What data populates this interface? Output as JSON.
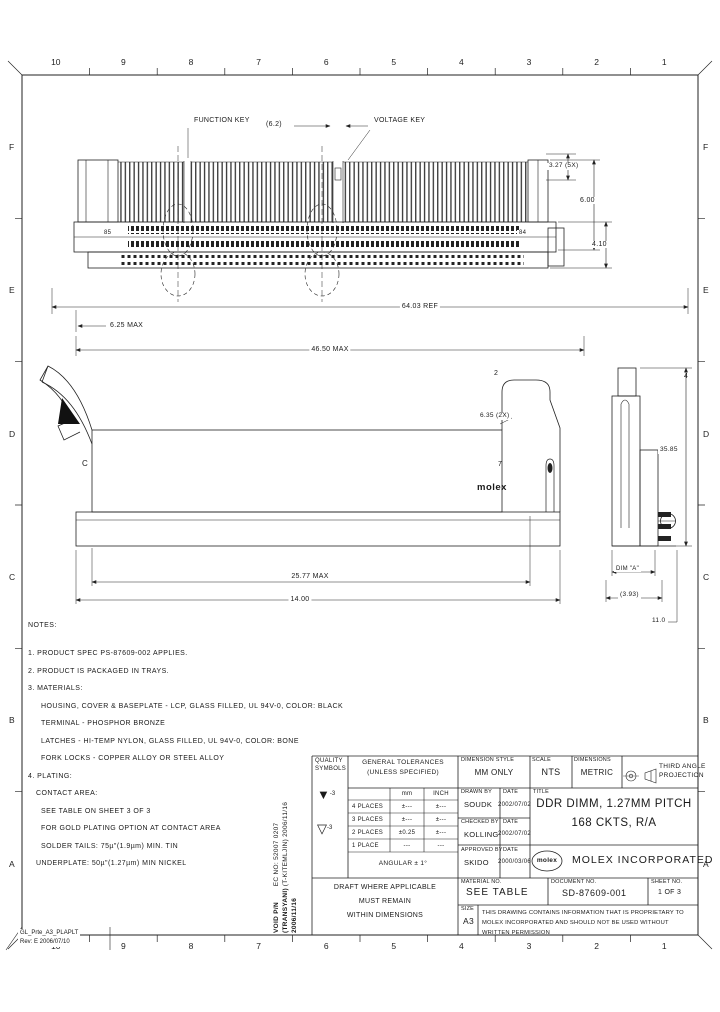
{
  "frame": {
    "columns": [
      "10",
      "9",
      "8",
      "7",
      "6",
      "5",
      "4",
      "3",
      "2",
      "1"
    ],
    "rows": [
      "F",
      "E",
      "D",
      "C",
      "B",
      "A"
    ],
    "corner_note_1": "GL_Prte_A3_PLAPLT",
    "corner_note_2": "Rev: E 2006/07/10"
  },
  "views": {
    "front": {
      "function_key_label": "FUNCTION KEY",
      "voltage_key_label": "VOLTAGE KEY",
      "dim_key": "(6.2)",
      "dim_pitch": "3.27 (5X)",
      "dim_height": "6.00",
      "dim_tail": "4.10",
      "pin_left": "85",
      "pin_right": "84",
      "dim_overall": "64.03 REF",
      "dim_end": "6.25 MAX",
      "dim_span": "46.50 MAX"
    },
    "side": {
      "section_label": "C",
      "balloon_top": "2",
      "balloon_slot": "7",
      "dim_latch": "6.35 (2X)",
      "logo": "molex",
      "dim_body": "25.77 MAX",
      "dim_base": "14.00"
    },
    "section": {
      "balloon": "4",
      "dim_height": "35.85",
      "dim_a": "DIM \"A\"",
      "dim_depth": "(3.93)",
      "dim_tail": "11.0"
    }
  },
  "notes": {
    "heading": "NOTES:",
    "lines": [
      "1. PRODUCT SPEC PS-87609-002 APPLIES.",
      "2. PRODUCT IS PACKAGED IN TRAYS.",
      "3. MATERIALS:",
      "HOUSING, COVER & BASEPLATE - LCP, GLASS FILLED, UL 94V-0, COLOR: BLACK",
      "TERMINAL - PHOSPHOR BRONZE",
      "LATCHES - HI-TEMP NYLON, GLASS FILLED, UL 94V-0, COLOR: BONE",
      "FORK LOCKS - COPPER ALLOY OR STEEL ALLOY",
      "4. PLATING:",
      "CONTACT AREA:",
      "SEE TABLE ON SHEET 3 OF 3",
      "FOR GOLD PLATING OPTION AT CONTACT AREA",
      "SOLDER TAILS: 75µ\"(1.9µm) MIN. TIN",
      "UNDERPLATE: 50µ\"(1.27µm) MIN NICKEL"
    ]
  },
  "ec_block": {
    "line_1": "VOID P/N",
    "line_2": "EC NO: 52007 0207",
    "line_3": "(TRANSYANI) 2006/11/16",
    "line_4": "(T-KITEMLJIN) 2006/11/16"
  },
  "title_block": {
    "quality_label_1": "QUALITY",
    "quality_label_2": "SYMBOLS",
    "quality_sym_1": "-3",
    "quality_sym_2": "-3",
    "tolerances": {
      "title_1": "GENERAL TOLERANCES",
      "title_2": "(UNLESS SPECIFIED)",
      "col_mm": "mm",
      "col_inch": "INCH",
      "rows": [
        {
          "label": "4 PLACES",
          "mm": "±---",
          "inch": "±---"
        },
        {
          "label": "3 PLACES",
          "mm": "±---",
          "inch": "±---"
        },
        {
          "label": "2 PLACES",
          "mm": "±0.25",
          "inch": "±---"
        },
        {
          "label": "1 PLACE",
          "mm": "---",
          "inch": "---"
        }
      ],
      "angular": "ANGULAR ± 1°"
    },
    "dim_style_label": "DIMENSION STYLE",
    "dim_style_value": "MM ONLY",
    "scale_label": "SCALE",
    "scale_value": "NTS",
    "dims_label": "DIMENSIONS",
    "dims_value": "METRIC",
    "projection_label_1": "THIRD ANGLE",
    "projection_label_2": "PROJECTION",
    "drawn_label": "DRAWN BY",
    "drawn_value": "SOUDK",
    "drawn_date_label": "DATE",
    "drawn_date_value": "2002/07/02",
    "checked_label": "CHECKED BY",
    "checked_value": "KOLLING",
    "checked_date_label": "DATE",
    "checked_date_value": "2002/07/02",
    "approved_label": "APPROVED BY",
    "approved_value": "SKIDO",
    "approved_date_label": "DATE",
    "approved_date_value": "2000/03/06",
    "title_label": "TITLE",
    "title_line_1": "DDR DIMM, 1.27MM PITCH",
    "title_line_2": "168 CKTS, R/A",
    "company_logo": "molex",
    "company_name": "MOLEX INCORPORATED",
    "material_label": "MATERIAL NO.",
    "material_value": "SEE TABLE",
    "document_label": "DOCUMENT NO.",
    "document_value": "SD-87609-001",
    "sheet_label": "SHEET NO.",
    "sheet_value": "1 OF 3",
    "draft_note_1": "DRAFT WHERE APPLICABLE",
    "draft_note_2": "MUST REMAIN",
    "draft_note_3": "WITHIN DIMENSIONS",
    "size_label": "SIZE",
    "size_value": "A3",
    "proprietary": "THIS DRAWING CONTAINS INFORMATION THAT IS PROPRIETARY TO MOLEX INCORPORATED AND SHOULD NOT BE USED WITHOUT WRITTEN PERMISSION"
  }
}
